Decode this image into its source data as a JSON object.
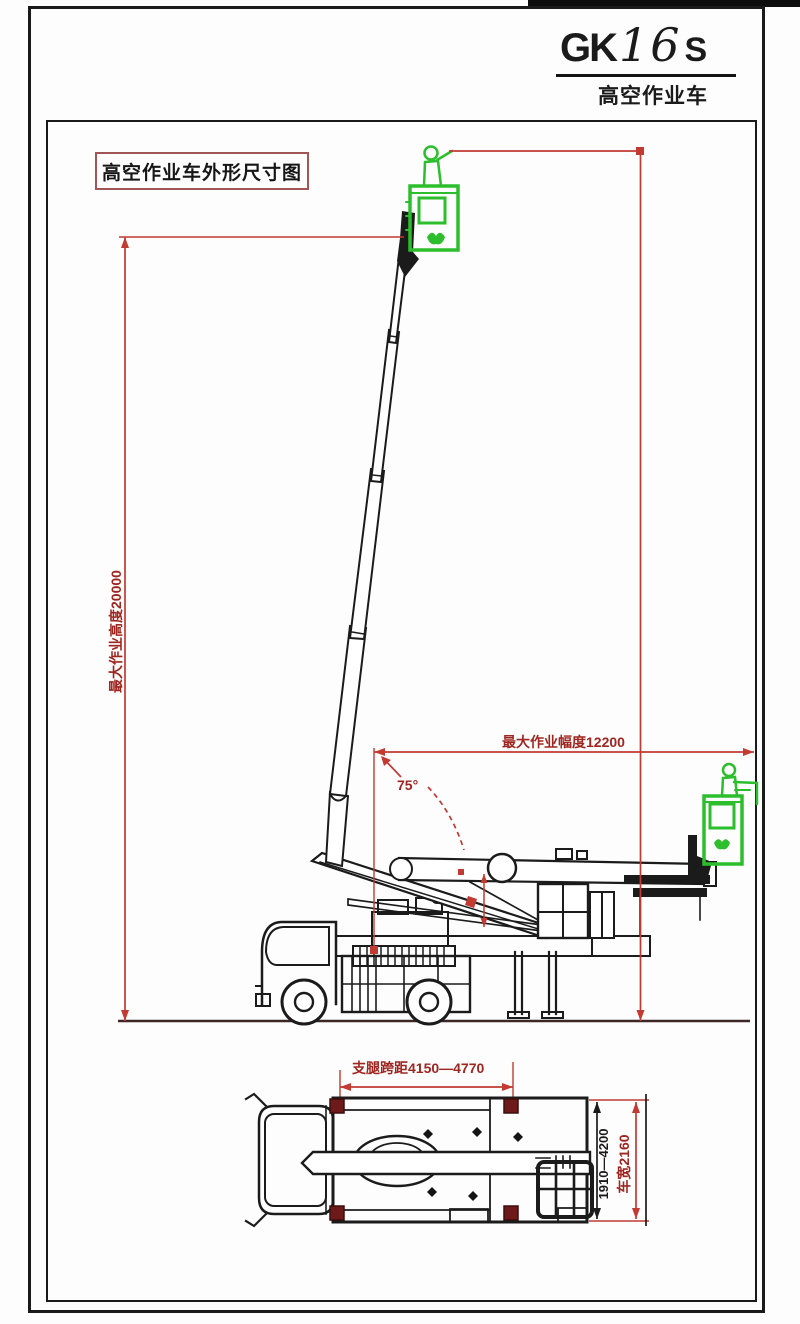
{
  "page": {
    "model": {
      "prefix": "GK",
      "number": "16",
      "suffix": "S"
    },
    "model_subtitle": "高空作业车",
    "drawing_label": "高空作业车外形尺寸图"
  },
  "dimensions": {
    "max_working_height": "最大作业高度20000",
    "max_working_reach": "最大作业幅度12200",
    "boom_angle": "75°",
    "outrigger_longitudinal_span": "支腿跨距4150—4770",
    "outrigger_lateral_span": "1910—4200",
    "vehicle_width": "车宽2160"
  },
  "colors": {
    "dimension_red": "#c23a32",
    "dimension_text_red": "#9f2620",
    "basket_green": "#2cbe2c",
    "outrigger_pad_maroon": "#6e1a1a",
    "line_black": "#1b1b1b",
    "label_box_red": "#a15555"
  }
}
